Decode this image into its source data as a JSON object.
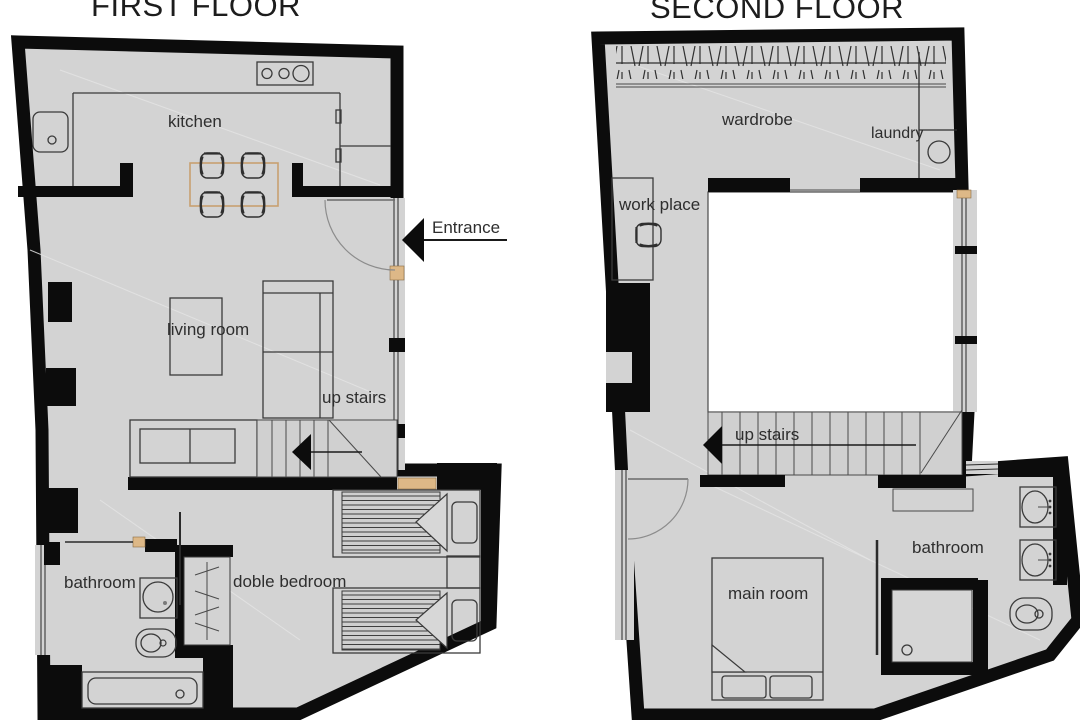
{
  "page": {
    "background": "#ffffff"
  },
  "colors": {
    "floor_gray": "#d3d3d3",
    "wall_black": "#0c0c0c",
    "void_white": "#ffffff",
    "threshold_wood": "#ddb887",
    "furniture_line": "#3a3a3a",
    "label_text": "#2e2e2e"
  },
  "first_floor": {
    "title": "FIRST FLOOR",
    "labels": {
      "kitchen": "kitchen",
      "entrance": "Entrance",
      "living_room": "living room",
      "up_stairs": "up stairs",
      "bathroom": "bathroom",
      "doble_bedroom": "doble bedroom"
    }
  },
  "second_floor": {
    "title": "SECOND FLOOR",
    "labels": {
      "wardrobe": "wardrobe",
      "laundry": "laundry",
      "work_place": "work place",
      "up_stairs": "up stairs",
      "bathroom": "bathroom",
      "main_room": "main room"
    }
  }
}
